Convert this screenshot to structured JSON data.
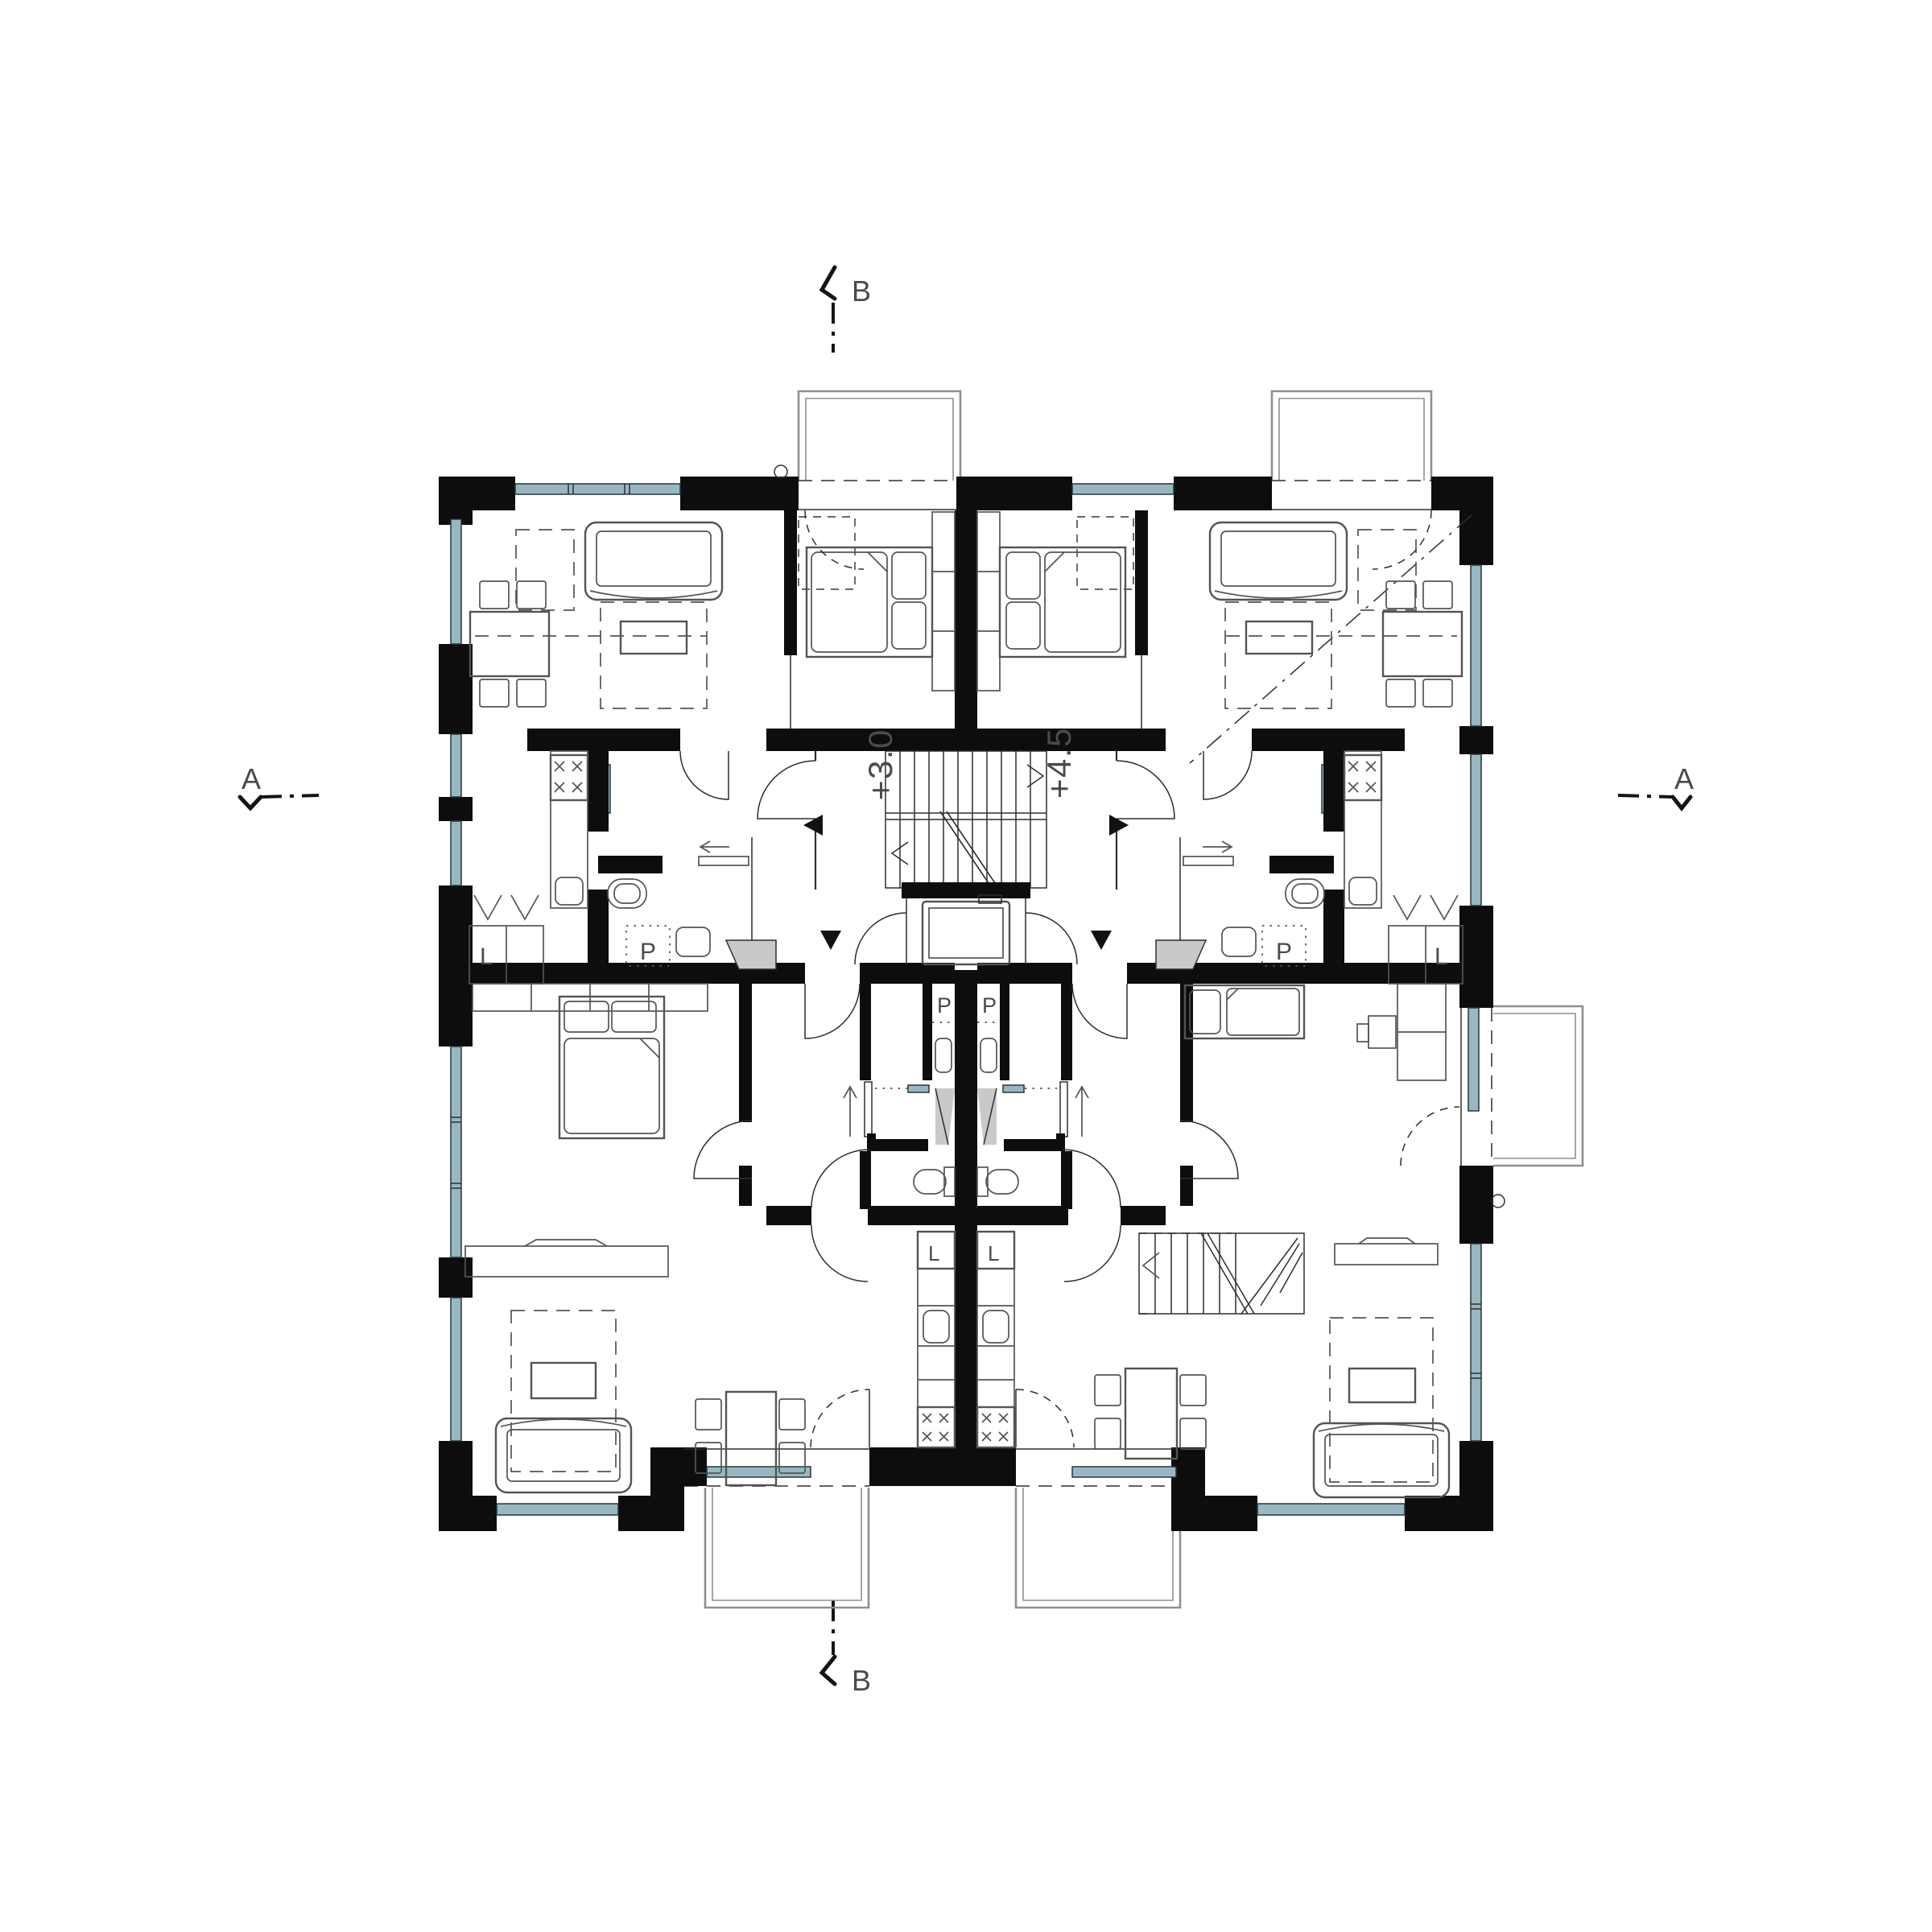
{
  "drawing": {
    "type": "architectural-floor-plan",
    "section_markers": {
      "top_label": "B",
      "bottom_label": "B",
      "left_label": "A",
      "right_label": "A"
    },
    "stair": {
      "level_label_left": "+3.0",
      "level_label_right": "+4.5"
    },
    "appliances": {
      "washing_machine_label": "P",
      "fridge_label": "L"
    },
    "colors": {
      "wall": "#0d0d0d",
      "line": "#2e2e2e",
      "furn": "#545454",
      "light": "#8f8f8f",
      "glass": "#9ab7c1",
      "grayfill": "#c9c9c9",
      "text": "#4a4a4a"
    }
  }
}
